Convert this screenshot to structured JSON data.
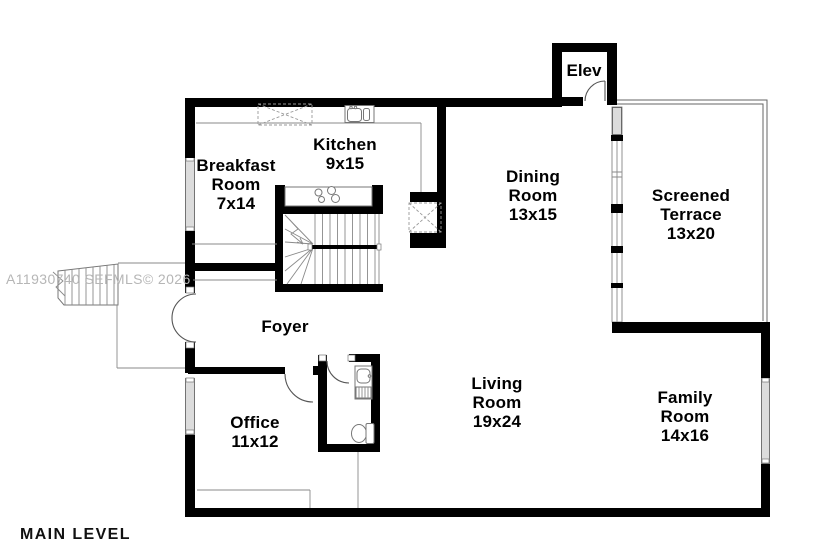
{
  "plan": {
    "level_title": "MAIN LEVEL",
    "watermark": "A11930740 SEFMLS© 2026",
    "rooms": {
      "elev": {
        "name": "Elev"
      },
      "breakfast": {
        "line1": "Breakfast",
        "line2": "Room",
        "dims": "7x14"
      },
      "kitchen": {
        "line1": "Kitchen",
        "dims": "9x15"
      },
      "dining": {
        "line1": "Dining",
        "line2": "Room",
        "dims": "13x15"
      },
      "terrace": {
        "line1": "Screened",
        "line2": "Terrace",
        "dims": "13x20"
      },
      "living": {
        "line1": "Living",
        "line2": "Room",
        "dims": "19x24"
      },
      "family": {
        "line1": "Family",
        "line2": "Room",
        "dims": "14x16"
      },
      "office": {
        "line1": "Office",
        "dims": "11x12"
      },
      "foyer": {
        "name": "Foyer"
      }
    },
    "colors": {
      "wall": "#000000",
      "thin_line": "#8a8a8a",
      "window_fill": "#dcdcdc",
      "watermark": "#b6b6b6"
    }
  }
}
